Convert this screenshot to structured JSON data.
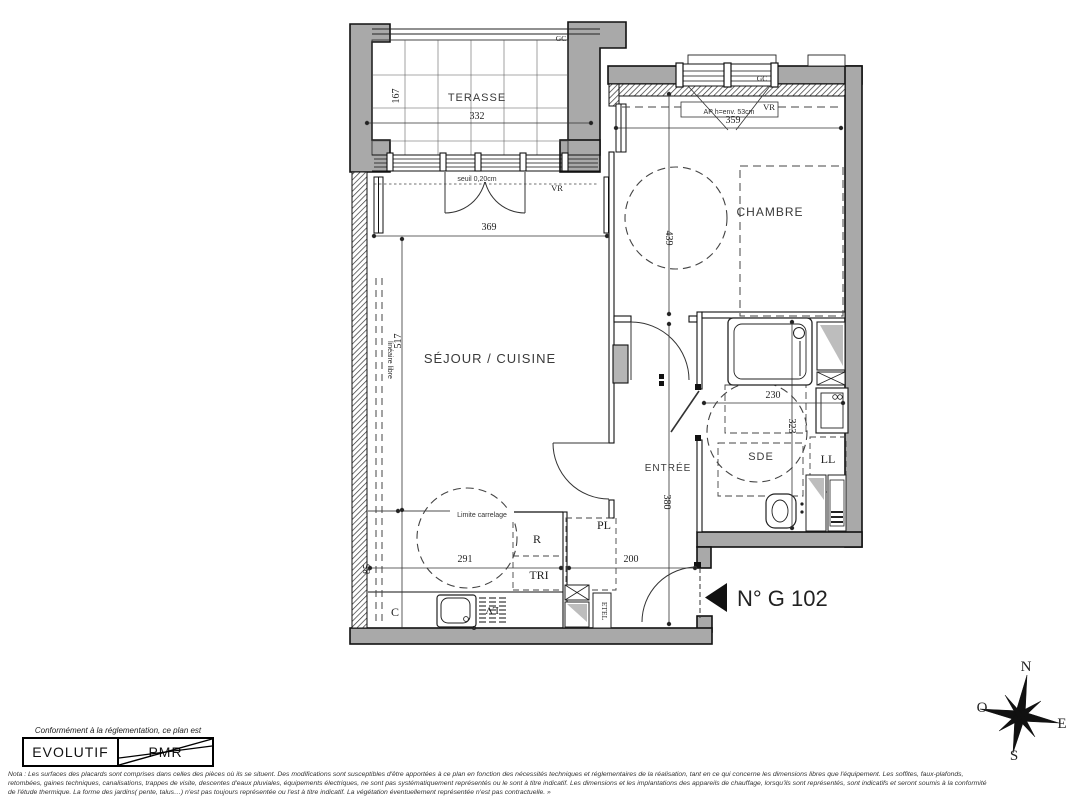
{
  "plan": {
    "unit_label": "N° G 102",
    "rooms": {
      "terrace": "TERASSE",
      "bedroom": "CHAMBRE",
      "living_kitchen": "SÉJOUR / CUISINE",
      "entrance": "ENTRÉE",
      "shower_room": "SDE"
    },
    "annotations": {
      "gc": "GC",
      "vr": "VR",
      "ap_window": "AP h=env. 53cm",
      "threshold": "seuil 0,20cm",
      "tile_limit": "Limite carrelage",
      "free_run": "linéaire libre",
      "washing_machine": "LL",
      "closet": "PL",
      "fridge": "R",
      "waste_sorting": "TRI",
      "kitchen_unit": "C",
      "dishwasher": "LV",
      "etel": "ETEL"
    },
    "dimensions": {
      "terrace_width": "332",
      "terrace_depth": "167",
      "living_width": "369",
      "living_depth": "517",
      "bedroom_width": "359",
      "bedroom_depth": "439",
      "shower_width": "230",
      "shower_depth": "323",
      "entrance_depth": "380",
      "kitchen_width": "291",
      "hall_width": "200",
      "counter_depth": "85"
    }
  },
  "compass": {
    "north": "N",
    "south": "S",
    "east": "E",
    "west": "O"
  },
  "legend": {
    "caption": "Conformément à la réglementation, ce plan est",
    "option_evolutif": "EVOLUTIF",
    "option_pmr": "PMR"
  },
  "nota": {
    "line1": "Nota : Les surfaces des placards sont comprises dans celles des pièces où ils se situent. Des modifications sont susceptibles d'être apportées à ce plan en fonction des nécessités techniques et réglementaires de la réalisation, tant en ce qui concerne les dimensions libres que l'équipement.  Les soffites, faux-plafonds,",
    "line2": "retombées, gaines techniques, canalisations, trappes de visite, descentes d'eaux pluviales, équipements électriques, ne sont pas systématiquement représentés ou le sont à titre indicatif. Les dimensions et les implantations des appareils de chauffage, lorsqu'ils sont représentés, sont indicatifs et seront soumis à la conformité",
    "line3": "de l'étude thermique. La forme des jardins( pente, talus…) n'est pas toujours représentée ou l'est à titre indicatif. La végétation éventuellement représentée n'est pas contractuelle. »"
  }
}
